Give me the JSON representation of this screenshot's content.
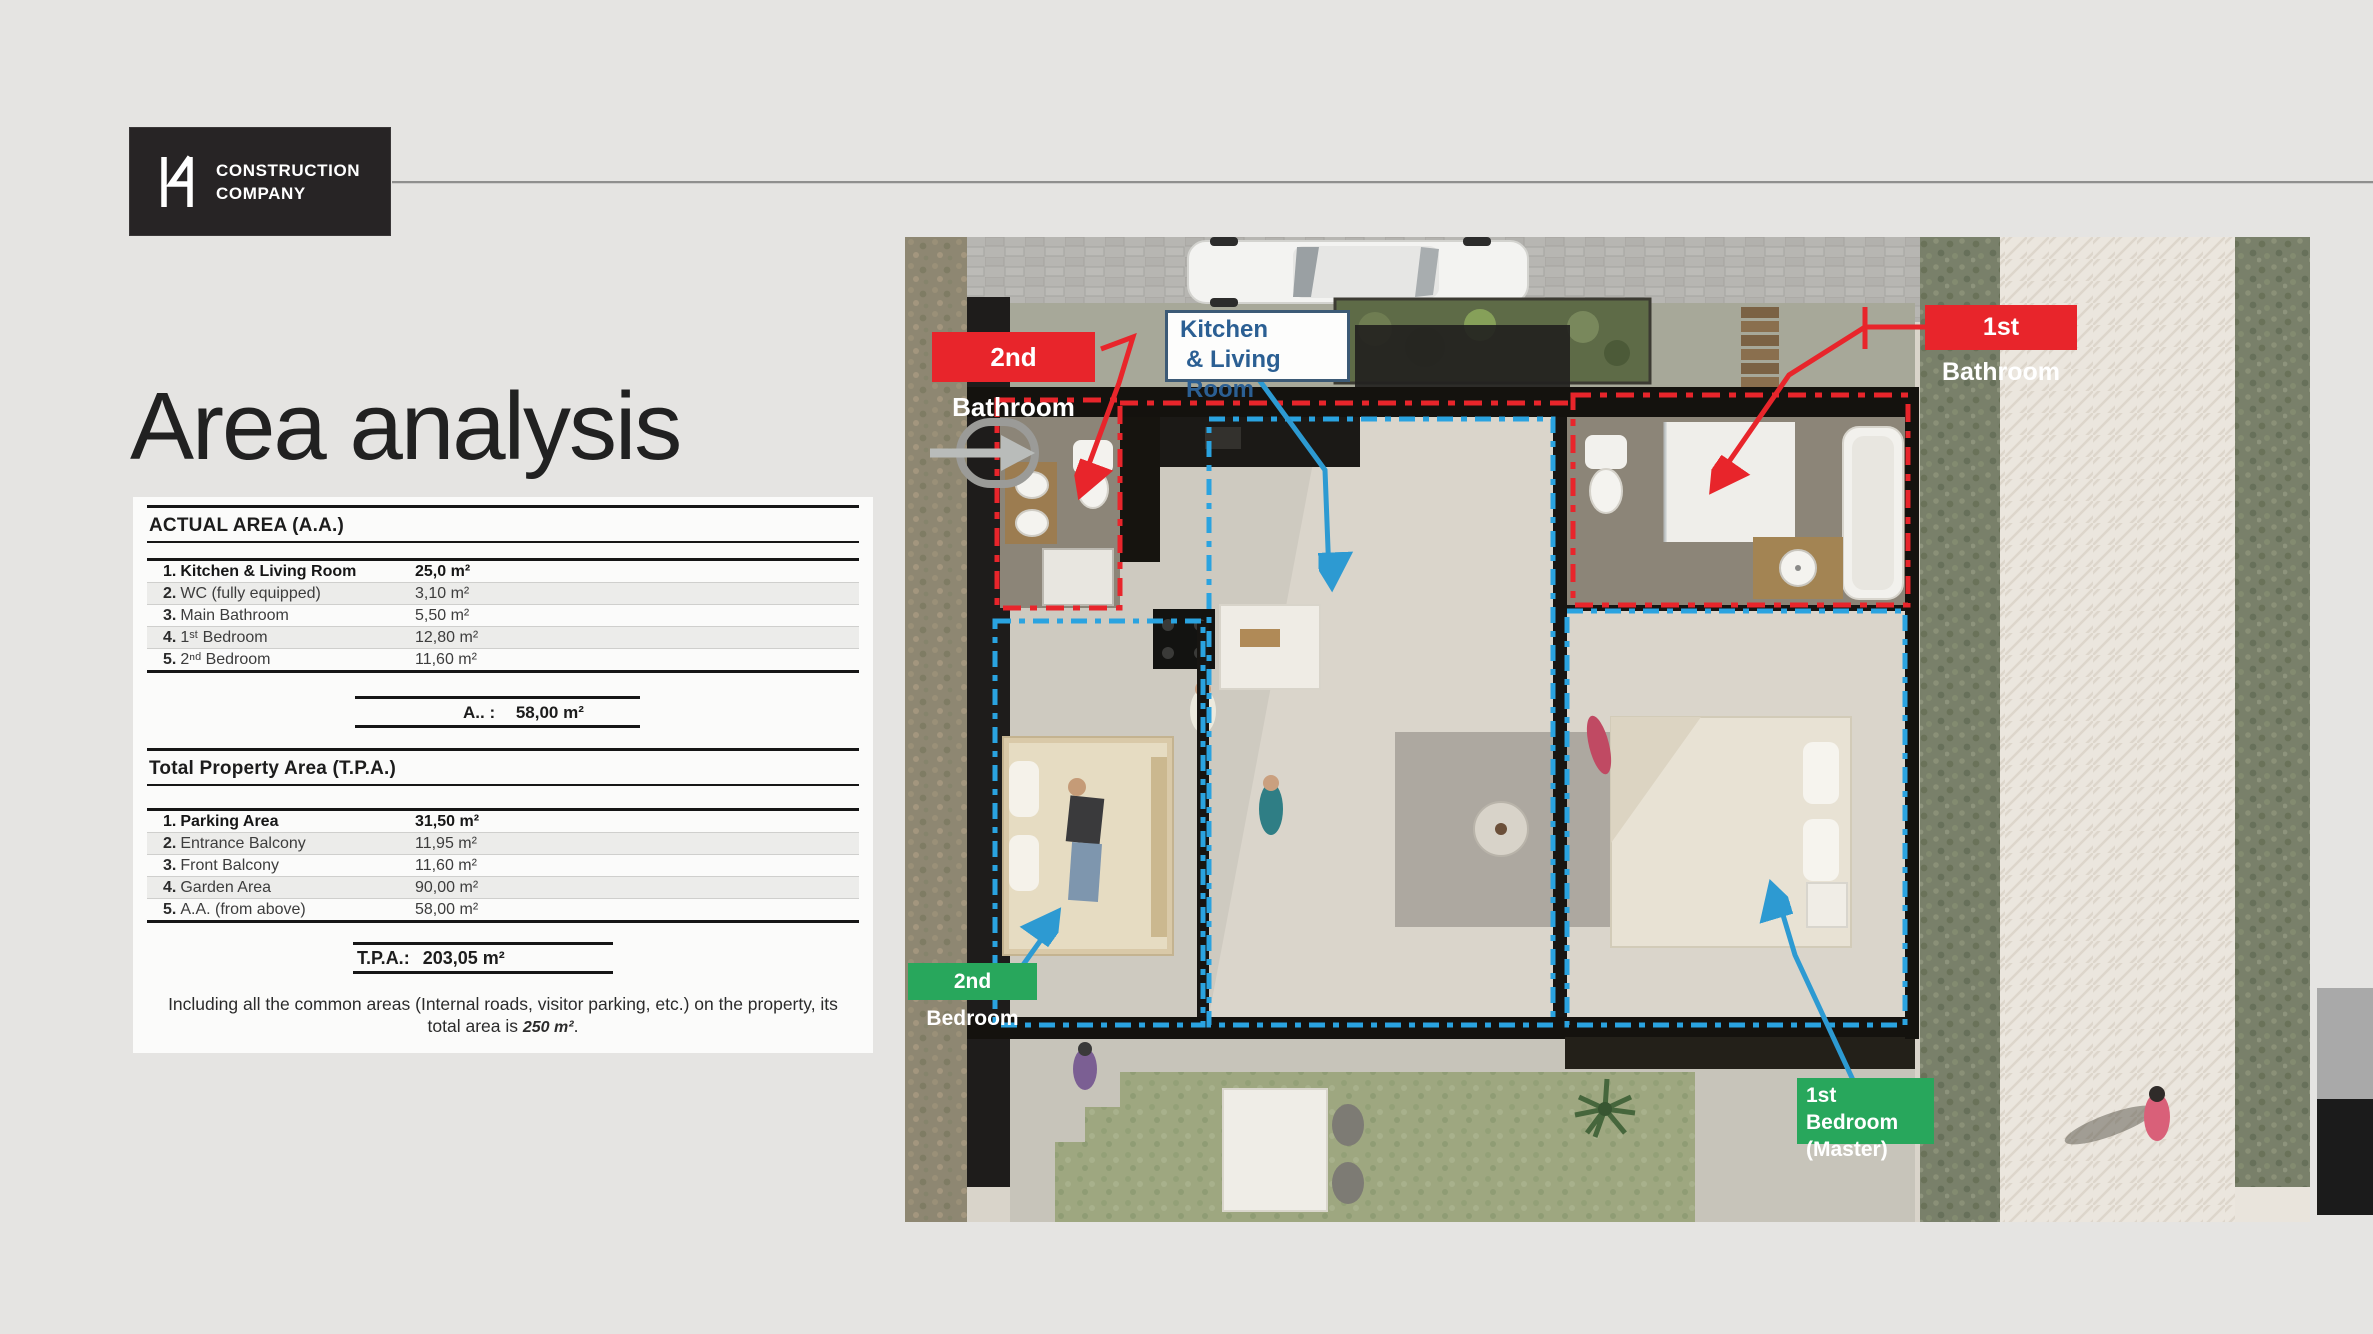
{
  "logo": {
    "name_line1": "CONSTRUCTION",
    "name_line2": "COMPANY"
  },
  "title": "Area analysis",
  "actual_area": {
    "heading": "ACTUAL  AREA (A.A.)",
    "rows": [
      {
        "num": "1.",
        "label": "Kitchen & Living Room",
        "value": "25,0 m²"
      },
      {
        "num": "2.",
        "label": "WC (fully equipped)",
        "value": "3,10 m²"
      },
      {
        "num": "3.",
        "label": "Main Bathroom",
        "value": "5,50 m²"
      },
      {
        "num": "4.",
        "label": "1ˢᵗ Bedroom",
        "value": "12,80 m²"
      },
      {
        "num": "5.",
        "label": "2ⁿᵈ Bedroom",
        "value": "11,60 m²"
      }
    ],
    "total_label": "A.. :",
    "total_value": "58,00 m²"
  },
  "total_property_area": {
    "heading": "Total Property Area (T.P.A.)",
    "rows": [
      {
        "num": "1.",
        "label": "Parking Area",
        "value": "31,50 m²"
      },
      {
        "num": "2.",
        "label": "Entrance Balcony",
        "value": "11,95 m²"
      },
      {
        "num": "3.",
        "label": "Front Balcony",
        "value": "11,60 m²"
      },
      {
        "num": "4.",
        "label": "Garden Area",
        "value": "90,00 m²"
      },
      {
        "num": "5.",
        "label": "A.A. (from above)",
        "value": "58,00 m²"
      }
    ],
    "total_label": "T.P.A.:",
    "total_value": "203,05 m²"
  },
  "note": {
    "before": "Including all the common areas (Internal roads, visitor parking, etc.) on the property, its total area is ",
    "bold": "250 m²",
    "after": "."
  },
  "floor_plan": {
    "labels": {
      "bathroom2": "2nd Bathroom",
      "kitchen_line1": "Kitchen",
      "kitchen_line2": "& Living Room",
      "bathroom1": "1st Bathroom",
      "bedroom2": "2nd Bedroom",
      "bedroom1_line1": "1st Bedroom",
      "bedroom1_line2": "(Master)"
    },
    "colors": {
      "label_red": "#e8252b",
      "label_green": "#28a75c",
      "kitchen_text_blue": "#2b5f93",
      "arrow_blue": "#2d9ad2",
      "dash_red": "#e8252b",
      "dash_blue": "#2aa3e0"
    }
  }
}
